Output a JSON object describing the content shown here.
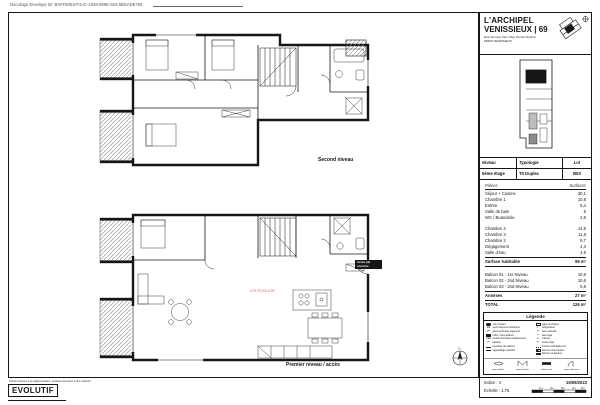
{
  "docusign": {
    "text": "DocuSign Envelope ID: BAFF50E3-F4AC-4329-969E-5DC6BDADE755"
  },
  "title_block": {
    "title": "L'ARCHIPEL",
    "subtitle": "VENISSIEUX | 69",
    "address_line1": "Rue Simone Veil / Rue Pernet Ducher",
    "address_line2": "69200 VENISSIEUX"
  },
  "info_table": {
    "headers": [
      "Niveau",
      "Typologie",
      "Lot"
    ],
    "values": [
      "5ème étage",
      "T5 Duplex",
      "B53"
    ]
  },
  "surfaces": {
    "headers": [
      "Pièces",
      "Surfaces"
    ],
    "rows_level1": [
      {
        "label": "Séjour + Cuisine",
        "value": "30,1"
      },
      {
        "label": "Chambre 1",
        "value": "10,8"
      },
      {
        "label": "Entrée",
        "value": "5,4"
      },
      {
        "label": "Salle de bain",
        "value": "5"
      },
      {
        "label": "WC / Buanderie",
        "value": "2,8"
      }
    ],
    "rows_level2": [
      {
        "label": "Chambre 4",
        "value": "14,8"
      },
      {
        "label": "Chambre 3",
        "value": "11,8"
      },
      {
        "label": "Chambre 2",
        "value": "9,7"
      },
      {
        "label": "Dégagement",
        "value": "4,3"
      },
      {
        "label": "Salle d'eau",
        "value": "4,9"
      }
    ],
    "habitable": {
      "label": "Surface habitable",
      "value": "99 m²"
    },
    "annex_rows": [
      {
        "label": "Balcon 01 - 1er Niveau",
        "value": "10,8"
      },
      {
        "label": "Balcon 02 - 2nd Niveau",
        "value": "10,6"
      },
      {
        "label": "Balcon 03 - 2nd Niveau",
        "value": "5,8"
      }
    ],
    "annexes": {
      "label": "Annexes",
      "value": "27 m²"
    },
    "total": {
      "label": "TOTAL",
      "value": "126 m²"
    }
  },
  "legend": {
    "title": "Légende",
    "left_items": [
      {
        "key": "",
        "label": "volet roulant"
      },
      {
        "key": "sm",
        "label": "seuil maçonné chanfreiné"
      },
      {
        "key": "gtl",
        "label": "gaine technique logement"
      },
      {
        "key": "",
        "label": "coffre / faux-plafond"
      },
      {
        "key": "mta",
        "label": "module thermique appartement"
      },
      {
        "key": "pl",
        "label": "placard"
      },
      {
        "key": "",
        "label": "retombée de plafond"
      },
      {
        "key": "",
        "label": "appareillage sanitaire"
      }
    ],
    "right_items": [
      {
        "key": "",
        "label": "gaine technique"
      },
      {
        "key": "r",
        "label": "réfrigérateur"
      },
      {
        "key": "lv",
        "label": "lave-vaisselle"
      },
      {
        "key": "ll",
        "label": "lave-linge"
      },
      {
        "key": "c",
        "label": "cuisson"
      },
      {
        "key": "sl",
        "label": "sèche-linge"
      },
      {
        "key": "",
        "label": "contour délimitation lot"
      },
      {
        "key": "",
        "label": "faïence toute hauteur"
      },
      {
        "key": "",
        "label": "faïence mi-hauteur"
      }
    ],
    "symbol_labels": [
      "porte palière",
      "porte-fenêtre",
      "châssis fixe",
      "porte intérieure"
    ]
  },
  "footer_panel": {
    "indice": "Indice : 4",
    "date": "15/09/2023",
    "scale": "Échelle : 1:75",
    "scale_ticks": [
      "1m",
      "2m",
      "3m",
      "4m",
      "5m"
    ]
  },
  "plans": {
    "second": {
      "label": "Second niveau"
    },
    "first": {
      "label": "Premier niveau / accès",
      "lot_label": "LOT ÉVOLUTIF",
      "access_label": "Accès par coursive"
    }
  },
  "footer": {
    "disclaimer": "Conformément à la réglementation, surfaces données à titre indicatif",
    "logo": "EVOLUTIF"
  },
  "colors": {
    "accent_red": "#e05e5e",
    "line": "#161616"
  }
}
